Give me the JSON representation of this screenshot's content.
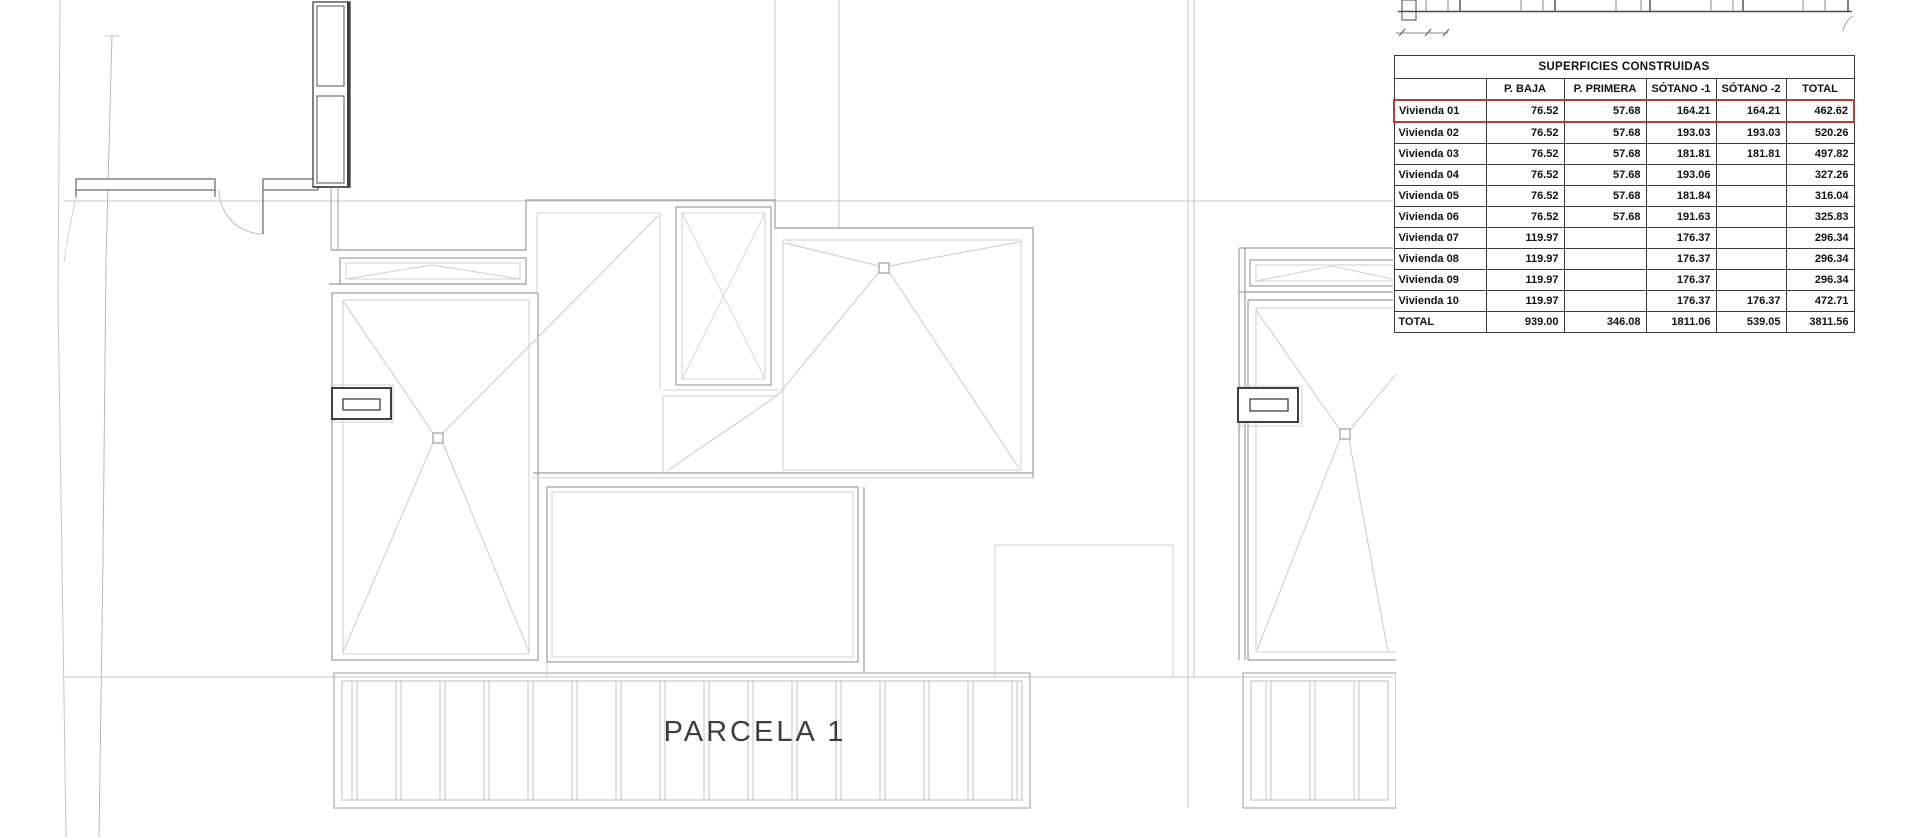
{
  "plan": {
    "parcel_label": "PARCELA 1",
    "highlight_color": "#b0413a",
    "drawing_type": "roof-plan"
  },
  "table": {
    "title": "SUPERFICIES CONSTRUIDAS",
    "columns": [
      "",
      "P. BAJA",
      "P. PRIMERA",
      "SÓTANO -1",
      "SÓTANO -2",
      "TOTAL"
    ],
    "rows": [
      {
        "label": "Vivienda 01",
        "values": [
          "76.52",
          "57.68",
          "164.21",
          "164.21",
          "462.62"
        ],
        "highlighted": true
      },
      {
        "label": "Vivienda 02",
        "values": [
          "76.52",
          "57.68",
          "193.03",
          "193.03",
          "520.26"
        ],
        "highlighted": false
      },
      {
        "label": "Vivienda 03",
        "values": [
          "76.52",
          "57.68",
          "181.81",
          "181.81",
          "497.82"
        ],
        "highlighted": false
      },
      {
        "label": "Vivienda 04",
        "values": [
          "76.52",
          "57.68",
          "193.06",
          "",
          "327.26"
        ],
        "highlighted": false
      },
      {
        "label": "Vivienda 05",
        "values": [
          "76.52",
          "57.68",
          "181.84",
          "",
          "316.04"
        ],
        "highlighted": false
      },
      {
        "label": "Vivienda 06",
        "values": [
          "76.52",
          "57.68",
          "191.63",
          "",
          "325.83"
        ],
        "highlighted": false
      },
      {
        "label": "Vivienda 07",
        "values": [
          "119.97",
          "",
          "176.37",
          "",
          "296.34"
        ],
        "highlighted": false
      },
      {
        "label": "Vivienda 08",
        "values": [
          "119.97",
          "",
          "176.37",
          "",
          "296.34"
        ],
        "highlighted": false
      },
      {
        "label": "Vivienda 09",
        "values": [
          "119.97",
          "",
          "176.37",
          "",
          "296.34"
        ],
        "highlighted": false
      },
      {
        "label": "Vivienda 10",
        "values": [
          "119.97",
          "",
          "176.37",
          "176.37",
          "472.71"
        ],
        "highlighted": false
      },
      {
        "label": "TOTAL",
        "values": [
          "939.00",
          "346.08",
          "1811.06",
          "539.05",
          "3811.56"
        ],
        "highlighted": false
      }
    ]
  }
}
